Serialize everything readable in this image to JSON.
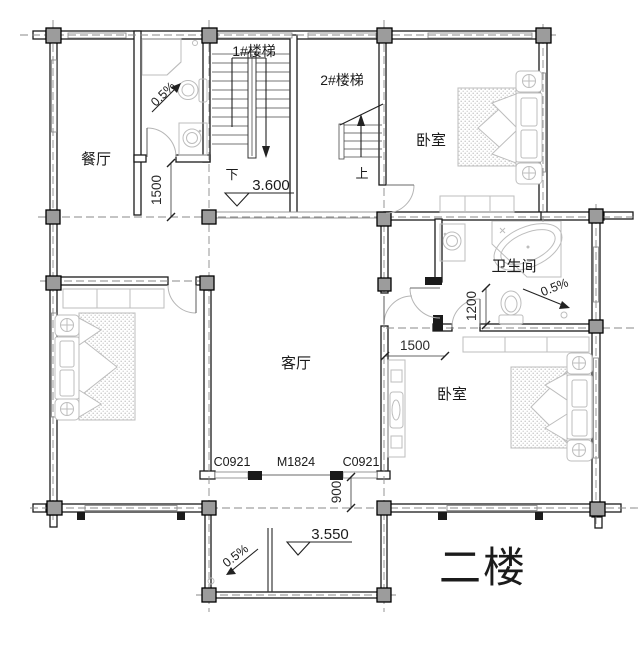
{
  "floor_plan": {
    "title": "二楼",
    "labels": {
      "dining": "餐厅",
      "stair1": "1#楼梯",
      "stair2": "2#楼梯",
      "bedroom_top_right": "卧室",
      "bathroom": "卫生间",
      "living": "客厅",
      "bedroom_bottom_right": "卧室",
      "stair1_direction": "下",
      "stair2_direction": "上"
    },
    "levels": {
      "stair_landing": "3.600",
      "balcony": "3.550"
    },
    "slopes": {
      "top_bathroom": "0.5%",
      "bathroom": "0.5%",
      "balcony": "0.5%"
    },
    "dimensions": {
      "hall_width": "1500",
      "bathroom_door_offset": "1200",
      "corridor_width": "1500",
      "balcony_offset": "900"
    },
    "opening_codes": {
      "window_left": "C0921",
      "door_center": "M1824",
      "window_right": "C0921"
    },
    "colors": {
      "wall": "#1b1b1b",
      "column": "#9c9c9c",
      "furniture": "#bdbdbd",
      "axis": "#8a8a8a"
    }
  }
}
